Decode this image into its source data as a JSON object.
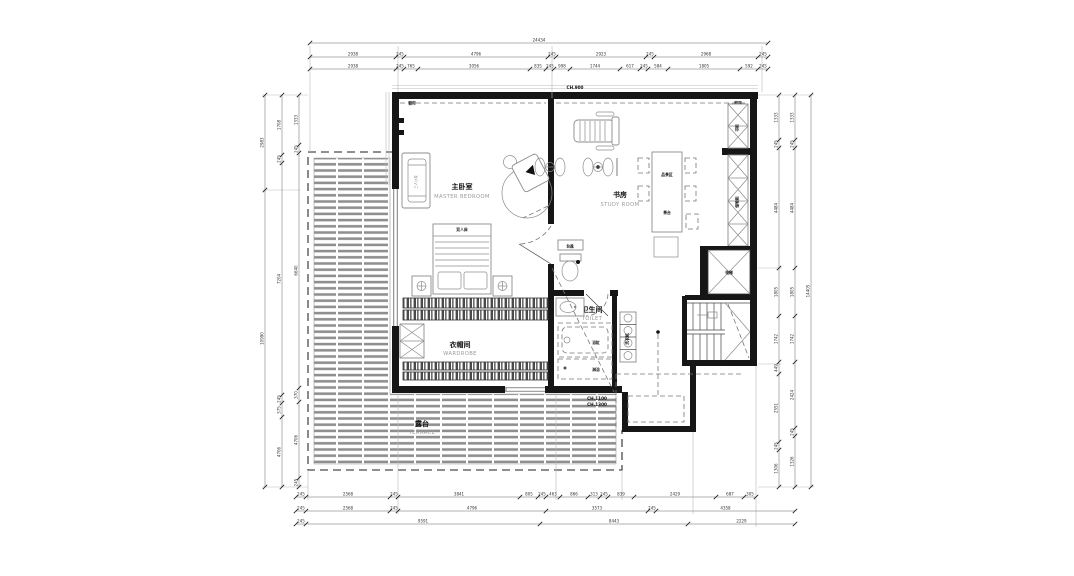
{
  "drawing": {
    "rooms": {
      "master": {
        "zh": "主卧室",
        "en": "MASTER BEDROOM"
      },
      "study": {
        "zh": "书房",
        "en": "STUDY ROOM"
      },
      "wardrobe": {
        "zh": "衣帽间",
        "en": "WARDROBE"
      },
      "toilet": {
        "zh": "卫生间",
        "en": "TOILET"
      },
      "terrace": {
        "zh": "露台",
        "en": "TERRACE"
      }
    },
    "areas": {
      "tea": "品茶区"
    },
    "fixtures": {
      "elevator": "电梯",
      "sofa": "三人沙发",
      "bed": "双人床",
      "tea_table": "茶台",
      "cabinet_upper": "书柜",
      "cabinet_lower": "储物柜",
      "washer": "洗衣机",
      "bathtub": "浴缸",
      "shower": "淋浴",
      "basin": "台盆",
      "curtain": "窗帘"
    },
    "ceiling": {
      "top": "CH.900",
      "mid1": "CH.1100",
      "mid2": "CH.1300"
    },
    "colors": {
      "line": "#161616",
      "furniture": "#8c8c8c",
      "dim": "#444444",
      "en_label": "#9a9a9a"
    },
    "dims": {
      "top_total": [
        "24434"
      ],
      "top_row2": [
        "2938",
        "245",
        "4796",
        "245",
        "2923",
        "245",
        "2968",
        "245"
      ],
      "top_row3": [
        "2938",
        "245",
        "765",
        "3056",
        "835",
        "245",
        "998",
        "1744",
        "617",
        "245",
        "584",
        "1805",
        "592",
        "245"
      ],
      "bottom_row1": [
        "245",
        "2568",
        "245",
        "3841",
        "805",
        "245",
        "463",
        "866",
        "313",
        "245",
        "839",
        "2429",
        "687",
        "305"
      ],
      "bottom_row2": [
        "245",
        "2568",
        "245",
        "4796",
        "3573",
        "245",
        "4358"
      ],
      "bottom_row3": [
        "245",
        "9591",
        "8443",
        "2229"
      ],
      "left_outer": [
        "2983",
        "10990"
      ],
      "left_mid": [
        "1708",
        "245",
        "7204",
        "245",
        "375",
        "4706"
      ],
      "left_inner": [
        "1333",
        "245",
        "6640",
        "370",
        "4706",
        "245"
      ],
      "right_inner": [
        "1333",
        "245",
        "4484",
        "1805",
        "1742",
        "449",
        "2551",
        "245",
        "1306"
      ],
      "right_mid": [
        "1333",
        "245",
        "4484",
        "1805",
        "1742",
        "2424",
        "245",
        "1326"
      ],
      "right_outer": [
        "14405"
      ]
    }
  }
}
